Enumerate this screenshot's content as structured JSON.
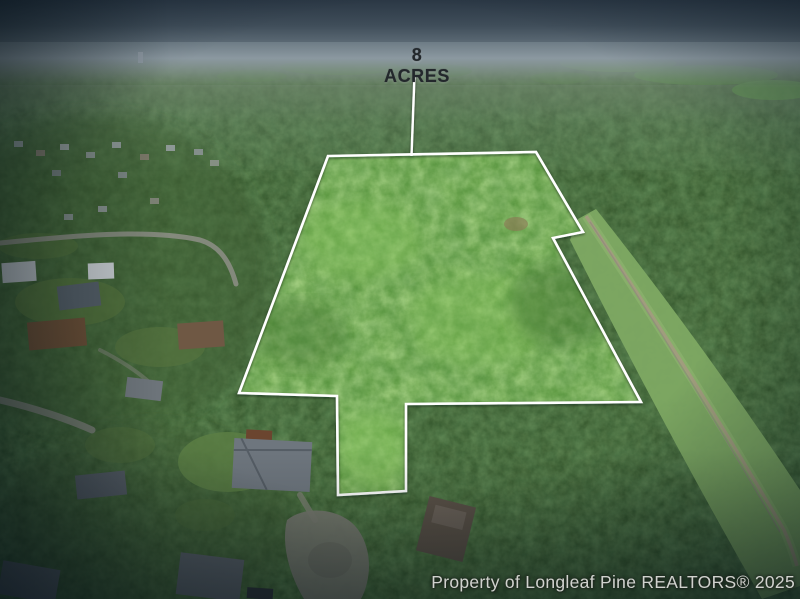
{
  "annotations": {
    "acreage_label": "8 ACRES",
    "watermark": "Property of Longleaf Pine REALTORS® 2025"
  },
  "scene": {
    "type": "aerial-drone-photo",
    "subject": "8-acre wooded land parcel outlined in white, bordered by a residential neighborhood to the west, a cleared utility corridor to the east, and dense forest all around",
    "colors": {
      "boundary_outline": "#ffffff",
      "acreage_text": "#23282c",
      "watermark_text": "#e8e9e6",
      "parcel_canopy": "#6aad46",
      "surrounding_forest": "#2b4d24",
      "sky_haze": "#8b98a0",
      "corridor_grass": "#86ac67"
    }
  }
}
